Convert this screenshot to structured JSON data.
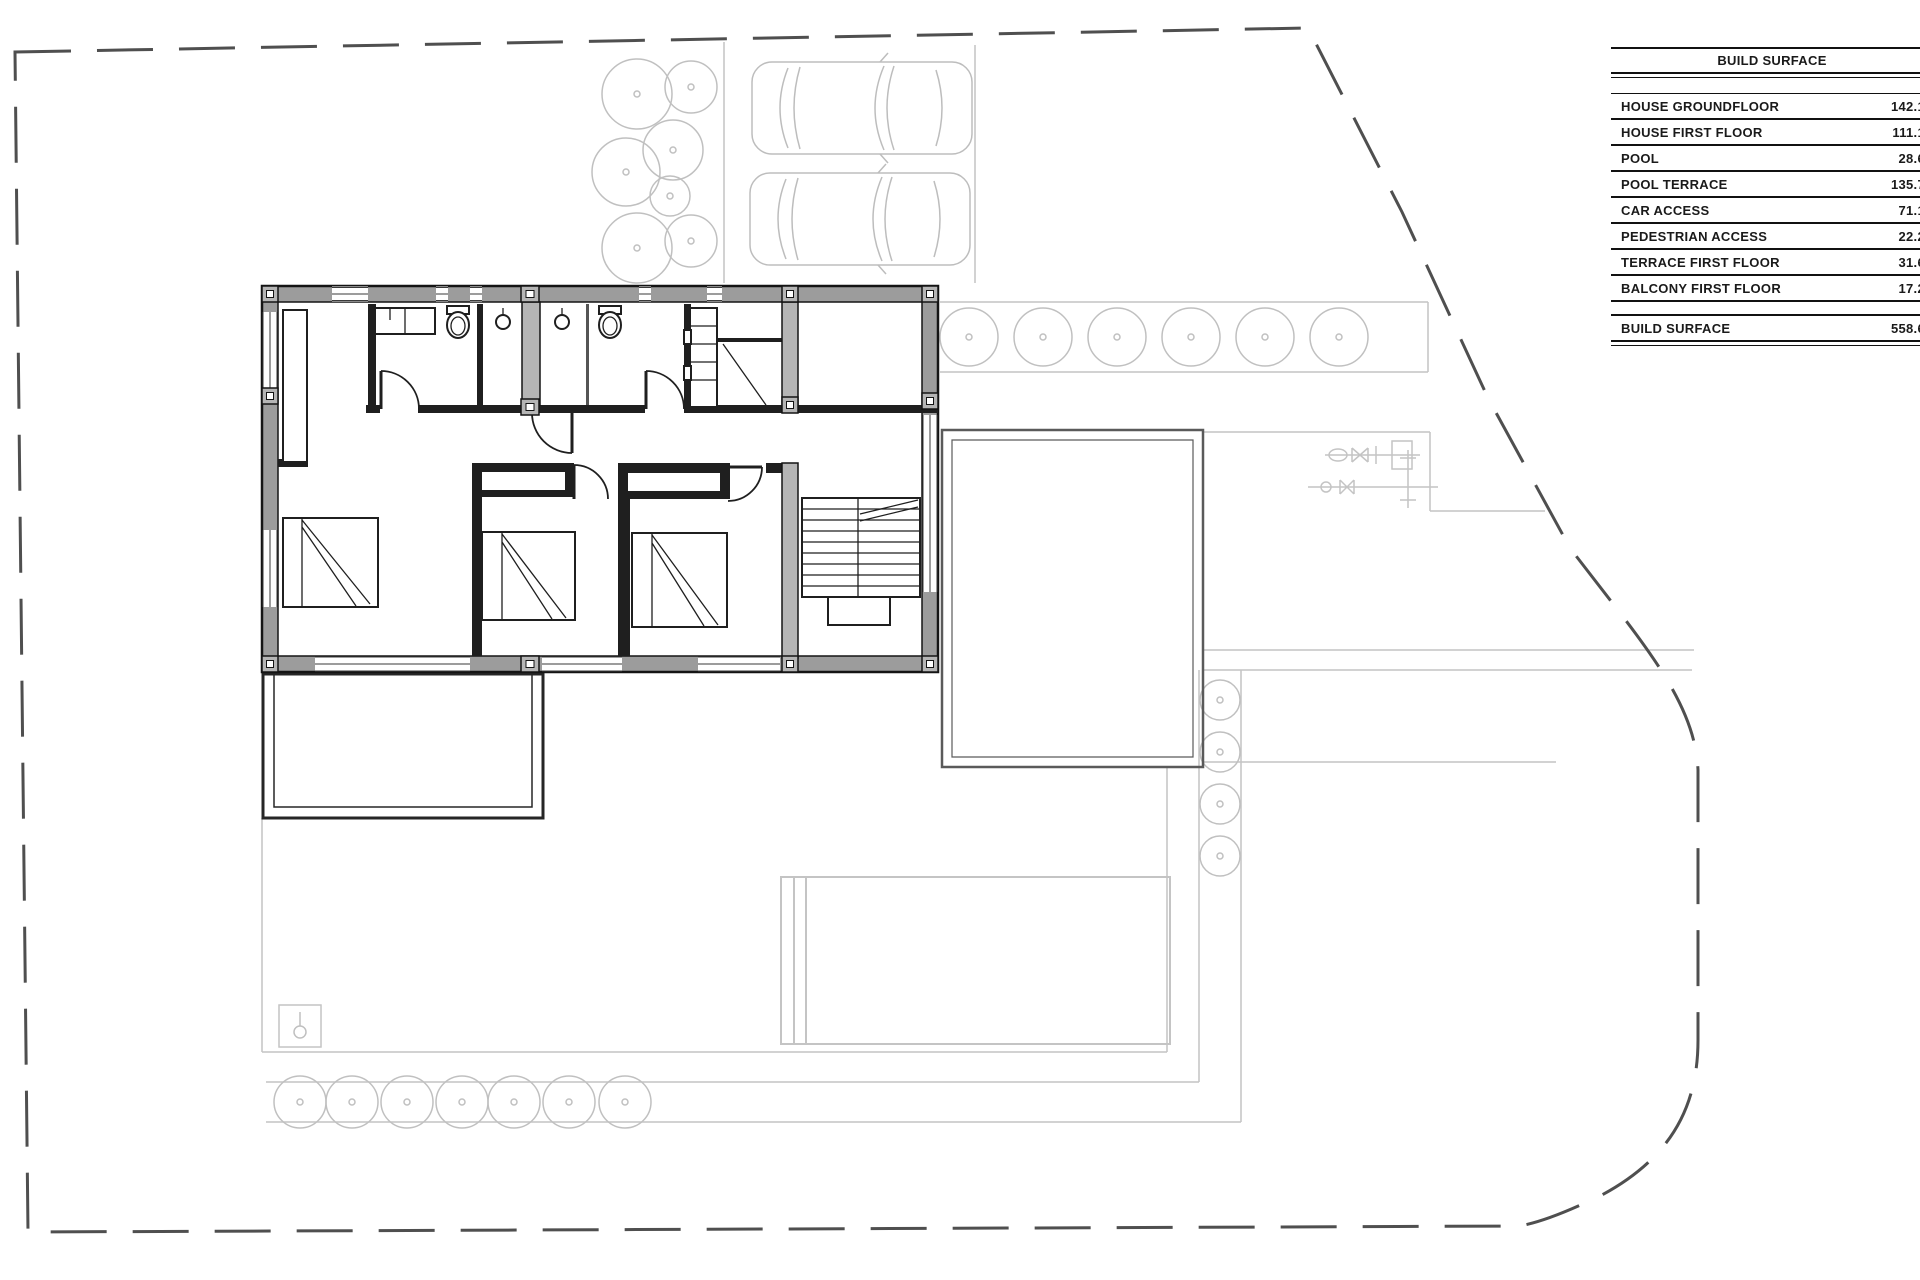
{
  "table": {
    "title": "BUILD SURFACE",
    "rows": [
      {
        "label": "HOUSE GROUNDFLOOR",
        "value": "142.1"
      },
      {
        "label": "HOUSE FIRST FLOOR",
        "value": "111.1"
      },
      {
        "label": "POOL",
        "value": "28.6"
      },
      {
        "label": "POOL TERRACE",
        "value": "135.7"
      },
      {
        "label": "CAR ACCESS",
        "value": "71.1"
      },
      {
        "label": "PEDESTRIAN ACCESS",
        "value": "22.2"
      },
      {
        "label": "TERRACE FIRST FLOOR",
        "value": "31.6"
      },
      {
        "label": "BALCONY FIRST FLOOR",
        "value": "17.2"
      }
    ],
    "total": {
      "label": "BUILD SURFACE",
      "value": "558.6"
    }
  },
  "plan": {
    "features": [
      "property-boundary",
      "house-first-floor-plan",
      "parking-cars",
      "tree-cluster",
      "tree-row-east",
      "tree-strip-right",
      "tree-row-south",
      "pool",
      "pool-terrace",
      "terrace-south-west",
      "deck-east",
      "planter",
      "utility-valves",
      "staircase",
      "beds",
      "bathroom-fixtures",
      "wardrobe",
      "shelving-unit"
    ]
  },
  "colors": {
    "background": "#ffffff",
    "wall_fill": "#9c9c9c",
    "wall_outline": "#141414",
    "interior_wall": "#1f1f1f",
    "pilaster_fill": "#b5b5b5",
    "site_light": "#c4c4c4",
    "vegetation": "#c0c0c0",
    "vehicle": "#bdbdbd",
    "boundary": "#4f4f4f",
    "terrace_outline": "#262626",
    "deck_outline": "#5a5a5a",
    "table_text": "#1a1a1a",
    "table_rule": "#111111"
  }
}
